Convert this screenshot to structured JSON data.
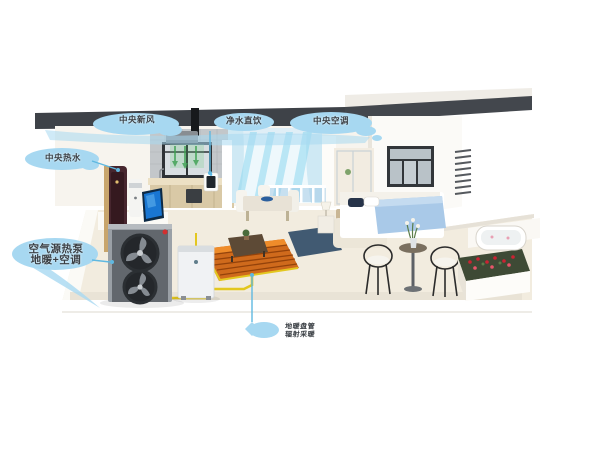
{
  "diagram": {
    "labels": {
      "fresh_air": "中央新风",
      "drinking_water": "净水直饮",
      "central_ac": "中央空调",
      "hot_water": "中央热水",
      "heat_pump_line1": "空气源热泵",
      "heat_pump_line2": "地暖+空调",
      "floor_heating_line1": "地暖盘管",
      "floor_heating_line2": "辐射采暖"
    },
    "colors": {
      "callout_cloud": "#a7d8f1",
      "callout_line": "#5fb8e0",
      "label_text": "#3a3f44",
      "ceiling_slab": "#3e4248",
      "pipe_yellow": "#e3c71f",
      "floor_heating": "#cf6a1c",
      "fresh_air_flow": "#5cb85c",
      "ac_airflow": "#8fd8f0",
      "bed_blanket": "#a9c9e8",
      "flower_red": "#cc2233"
    }
  }
}
